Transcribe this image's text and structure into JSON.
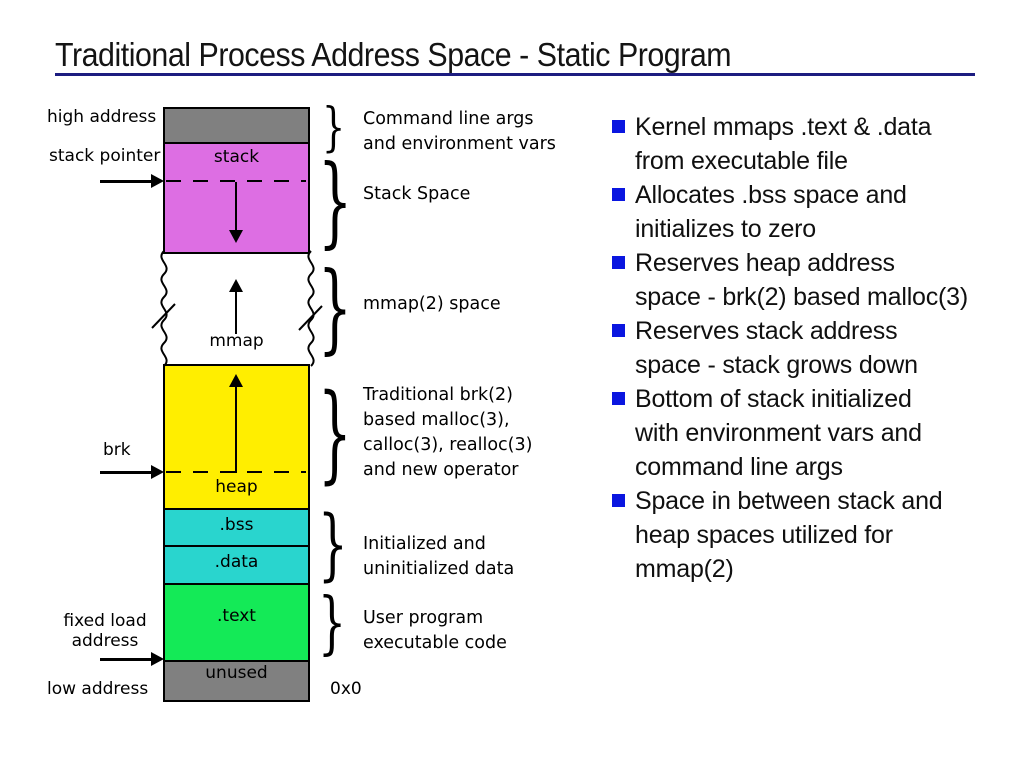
{
  "slide": {
    "title": "Traditional Process Address Space - Static Program",
    "colors": {
      "title_rule": "#1c1c80",
      "bullet": "#0a16e0",
      "gray": "#808080",
      "stack": "#dd6ee3",
      "heap": "#ffee00",
      "bss_data": "#29d5ce",
      "text": "#14ea57"
    }
  },
  "diagram": {
    "segments": [
      {
        "name": "args-env",
        "label": "",
        "color": "#808080"
      },
      {
        "name": "stack",
        "label": "stack",
        "color": "#dd6ee3"
      },
      {
        "name": "mmap-gap",
        "label": "mmap",
        "color": "#ffffff"
      },
      {
        "name": "heap",
        "label": "heap",
        "color": "#ffee00"
      },
      {
        "name": "bss",
        "label": ".bss",
        "color": "#29d5ce"
      },
      {
        "name": "data",
        "label": ".data",
        "color": "#29d5ce"
      },
      {
        "name": "text",
        "label": ".text",
        "color": "#14ea57"
      },
      {
        "name": "unused",
        "label": "unused",
        "color": "#808080"
      }
    ],
    "pointers": {
      "high_address": "high address",
      "stack_pointer": "stack pointer",
      "brk": "brk",
      "fixed_load_line1": "fixed load",
      "fixed_load_line2": "address",
      "low_address": "low address"
    },
    "base_address": "0x0",
    "annotations": [
      {
        "lines": [
          "Command line args",
          "and environment vars"
        ]
      },
      {
        "lines": [
          "Stack Space"
        ]
      },
      {
        "lines": [
          "mmap(2) space"
        ]
      },
      {
        "lines": [
          "Traditional brk(2)",
          "based malloc(3),",
          "calloc(3), realloc(3)",
          "and new operator"
        ]
      },
      {
        "lines": [
          "Initialized and",
          "uninitialized data"
        ]
      },
      {
        "lines": [
          "User program",
          "executable code"
        ]
      }
    ]
  },
  "bullets": [
    {
      "lines": [
        "Kernel mmaps .text & .data",
        "from executable file"
      ]
    },
    {
      "lines": [
        "Allocates .bss space and",
        "initializes to zero"
      ]
    },
    {
      "lines": [
        "Reserves heap address",
        "space - brk(2) based malloc(3)"
      ]
    },
    {
      "lines": [
        "Reserves stack address",
        "space - stack grows down"
      ]
    },
    {
      "lines": [
        "Bottom of stack initialized",
        "with environment vars and",
        "command line args"
      ]
    },
    {
      "lines": [
        "Space in between stack and",
        "heap spaces utilized for",
        "mmap(2)"
      ]
    }
  ]
}
